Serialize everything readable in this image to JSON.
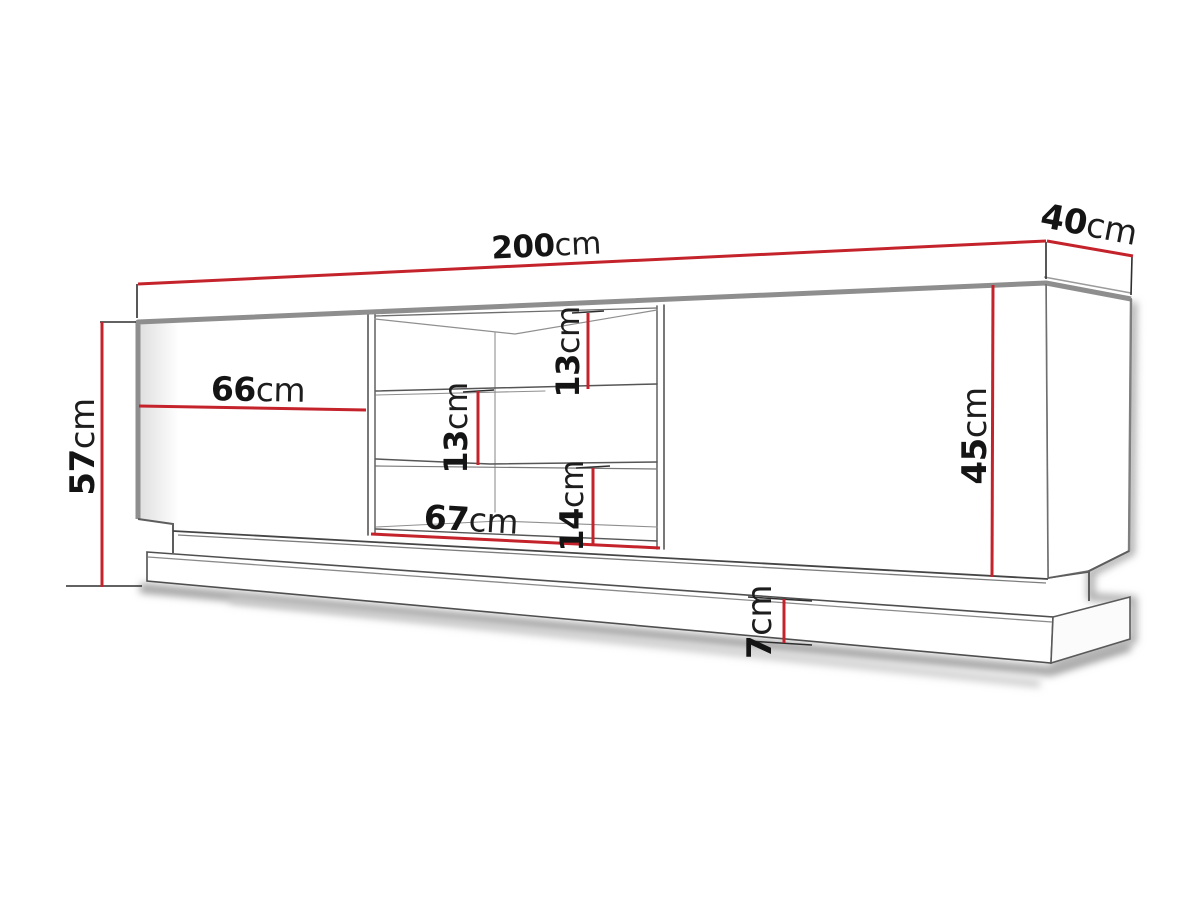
{
  "diagram": {
    "type": "furniture-dimension-drawing",
    "unit": "cm",
    "dimensions": {
      "total_width": {
        "value": "200",
        "unit": "cm",
        "orientation": "horizontal",
        "location": "top edge of cabinet"
      },
      "depth": {
        "value": "40",
        "unit": "cm",
        "orientation": "diagonal",
        "location": "top right, cabinet depth"
      },
      "total_height": {
        "value": "57",
        "unit": "cm",
        "orientation": "vertical",
        "location": "left side, overall height"
      },
      "left_door_width": {
        "value": "66",
        "unit": "cm",
        "orientation": "horizontal",
        "location": "left door panel"
      },
      "niche_width": {
        "value": "67",
        "unit": "cm",
        "orientation": "horizontal",
        "location": "open shelf niche bottom"
      },
      "niche_top_height": {
        "value": "13",
        "unit": "cm",
        "orientation": "vertical",
        "location": "upper shelf opening"
      },
      "niche_mid_height": {
        "value": "13",
        "unit": "cm",
        "orientation": "vertical",
        "location": "middle shelf opening"
      },
      "niche_bottom_height": {
        "value": "14",
        "unit": "cm",
        "orientation": "vertical",
        "location": "lower shelf opening"
      },
      "body_height": {
        "value": "45",
        "unit": "cm",
        "orientation": "vertical",
        "location": "right door panel height"
      },
      "plinth_height": {
        "value": "7",
        "unit": "cm",
        "orientation": "vertical",
        "location": "base plinth"
      }
    },
    "colors": {
      "dimension_line": "#c4232b",
      "extension_line": "#2e2e2e",
      "edge_thick": "#8e8e8e",
      "edge_thin": "#555555",
      "text_number": "#141414",
      "text_unit": "#1d1d1d",
      "background": "#ffffff"
    }
  }
}
